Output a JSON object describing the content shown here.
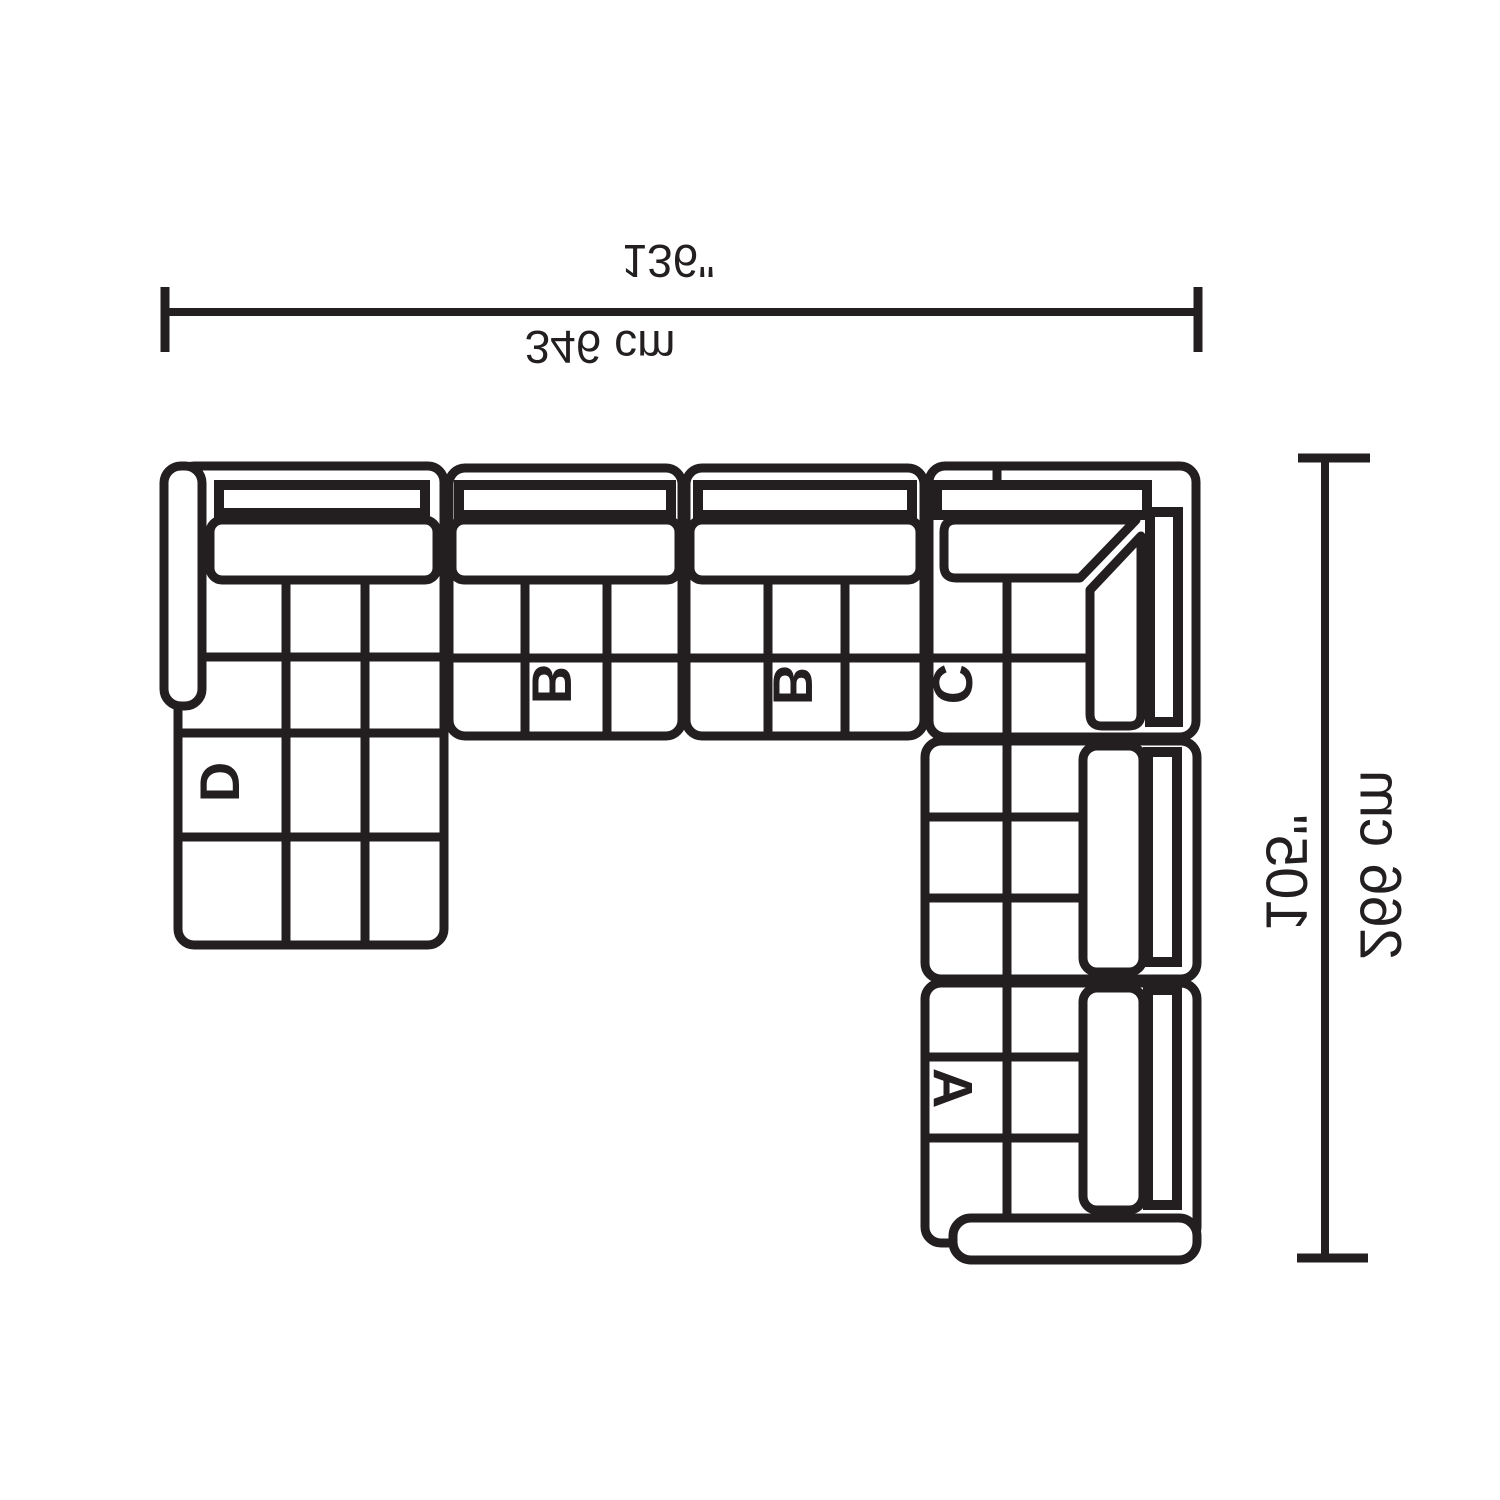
{
  "diagram": {
    "dimensions": {
      "width_inches": "136\"",
      "width_cm": "346 cm",
      "height_inches": "105\"",
      "height_cm": "266 cm"
    },
    "section_labels": {
      "a": "A",
      "b1": "B",
      "b2": "B",
      "c": "C",
      "d": "D"
    },
    "colors": {
      "line": "#231f20",
      "background": "#ffffff"
    }
  }
}
